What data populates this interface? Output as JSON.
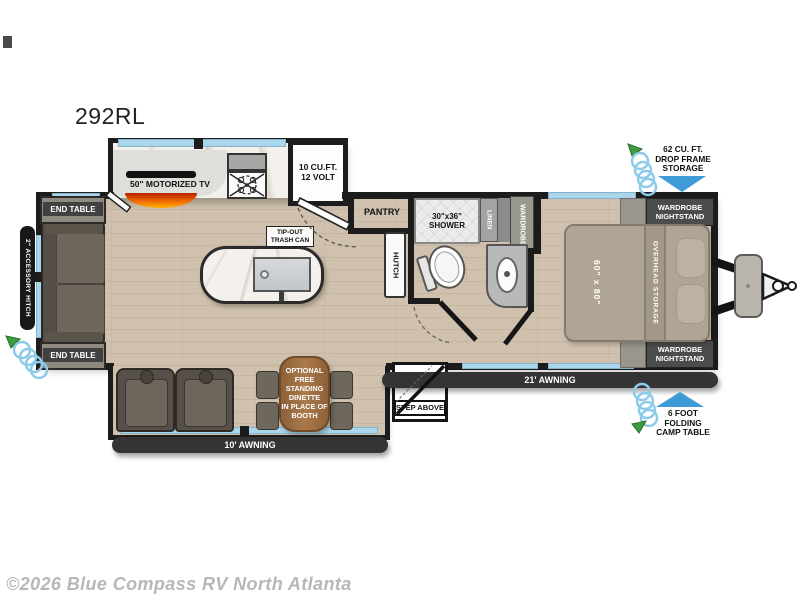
{
  "page": {
    "title": "292RL",
    "watermark": "©2026 Blue Compass RV North Atlanta"
  },
  "colors": {
    "wall": "#1c1c1c",
    "window_blue": "#a9d6ea",
    "arrow_blue": "#3f9bd8",
    "floor_wood": "#cfc1ae",
    "awning_bar": "#343434",
    "dinette_table_brown": "#9c6b42",
    "flame_top": "#b71f00",
    "flame_bottom": "#ffb400",
    "hose_coil": "#8ccbe9",
    "hose_nozzle_green": "#3d9c3d"
  },
  "kitchen": {
    "tv": "50\" MOTORIZED TV",
    "fridge": "10 CU.FT.\n12 VOLT",
    "trash": "TIP-OUT\nTRASH CAN",
    "pantry": "PANTRY",
    "hutch": "HUTCH"
  },
  "bath": {
    "shower": "30\"x36\"\nSHOWER",
    "linen": "LINEN",
    "wardrobe": "WARDROBE"
  },
  "living": {
    "end_table_top": "END TABLE",
    "end_table_bottom": "END TABLE",
    "dinette_note": "OPTIONAL\nFREE\nSTANDING\nDINETTE\nIN PLACE OF\nBOOTH"
  },
  "bedroom": {
    "nightstand_top": "WARDROBE\nNIGHTSTAND",
    "nightstand_bottom": "WARDROBE\nNIGHTSTAND",
    "overhead": "OVERHEAD STORAGE",
    "bed_size": "60\" x 80\""
  },
  "exterior": {
    "awning_21": "21' AWNING",
    "awning_10": "10' AWNING",
    "step": "STEP ABOVE",
    "hitch": "2\" ACCESSORY HITCH",
    "storage": "62 CU. FT.\nDROP FRAME\nSTORAGE",
    "camp_table": "6 FOOT\nFOLDING\nCAMP TABLE"
  }
}
